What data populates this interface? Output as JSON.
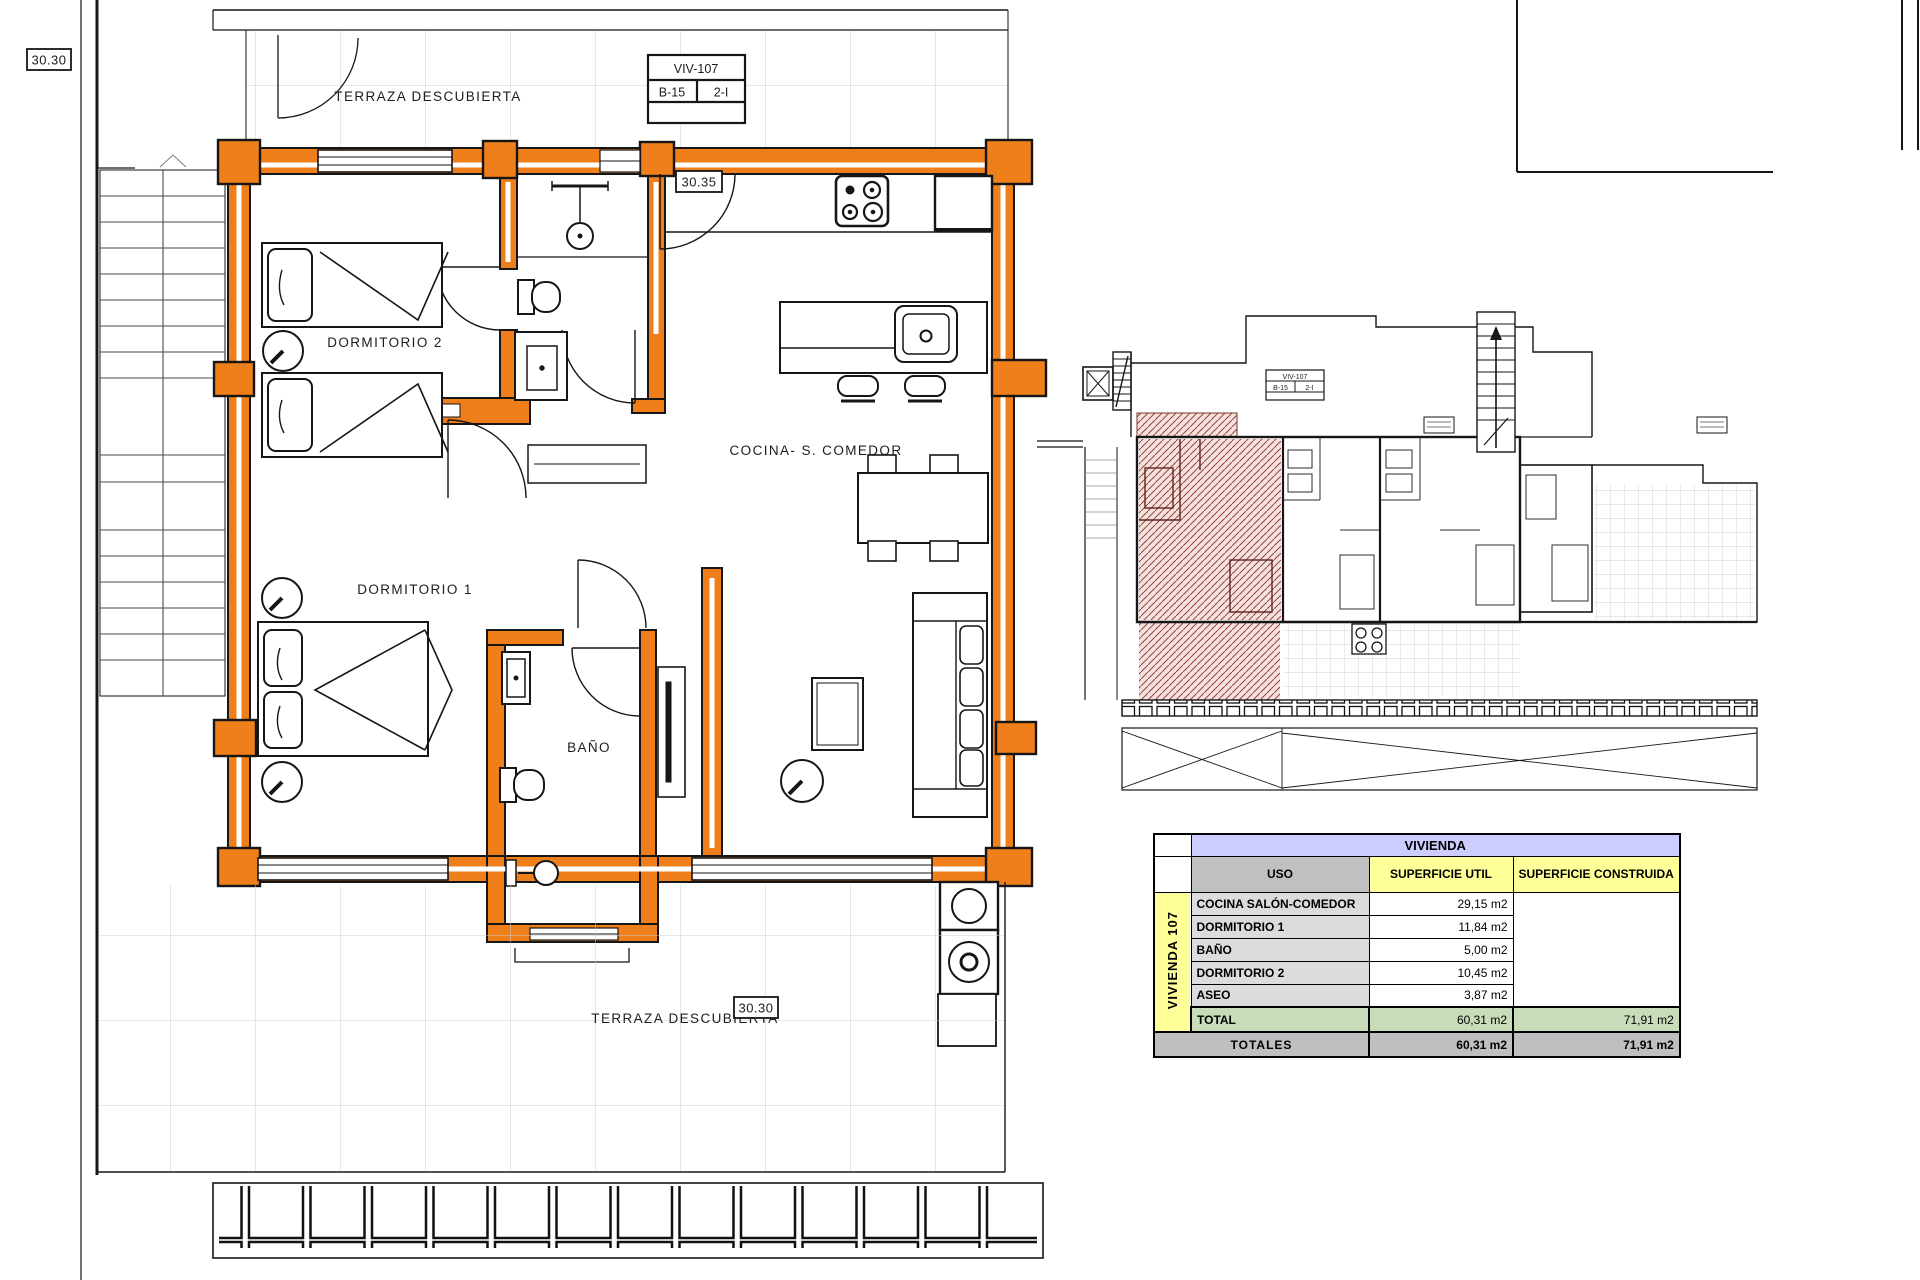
{
  "plan": {
    "labels": {
      "terraza_top": "TERRAZA DESCUBIERTA",
      "terraza_bottom": "TERRAZA DESCUBIERTA",
      "dormitorio2": "DORMITORIO 2",
      "dormitorio1": "DORMITORIO 1",
      "cocina": "COCINA- S. COMEDOR",
      "bano": "BAÑO"
    },
    "refs": {
      "top_left": "30.30",
      "mid": "30.35",
      "bottom": "30.30"
    },
    "title_block": {
      "unit": "VIV-107",
      "block": "B-15",
      "floor": "2-I"
    }
  },
  "overview": {
    "title_block": {
      "unit": "VIV-107",
      "block": "B-15",
      "floor": "2-I"
    }
  },
  "table": {
    "title": "VIVIENDA",
    "row_group_label": "VIVIENDA 107",
    "columns": {
      "uso": "USO",
      "util": "SUPERFICIE UTIL",
      "construida": "SUPERFICIE CONSTRUIDA"
    },
    "rows": [
      {
        "uso": "COCINA SALÓN-COMEDOR",
        "util": "29,15 m2"
      },
      {
        "uso": "DORMITORIO 1",
        "util": "11,84 m2"
      },
      {
        "uso": "BAÑO",
        "util": "5,00 m2"
      },
      {
        "uso": "DORMITORIO 2",
        "util": "10,45 m2"
      },
      {
        "uso": "ASEO",
        "util": "3,87 m2"
      }
    ],
    "total": {
      "label": "TOTAL",
      "util": "60,31 m2",
      "construida": "71,91 m2"
    },
    "totales": {
      "label": "TOTALES",
      "util": "60,31 m2",
      "construida": "71,91 m2"
    }
  },
  "colors": {
    "wall_orange": "#EE7F1B",
    "hatch_red": "#9A443C",
    "table_title_bg": "#CCCCFF",
    "table_header_yellow": "#FFFF99",
    "table_gray": "#C0C0C0",
    "table_total_green": "#C9DCB9",
    "line_black": "#161616"
  }
}
